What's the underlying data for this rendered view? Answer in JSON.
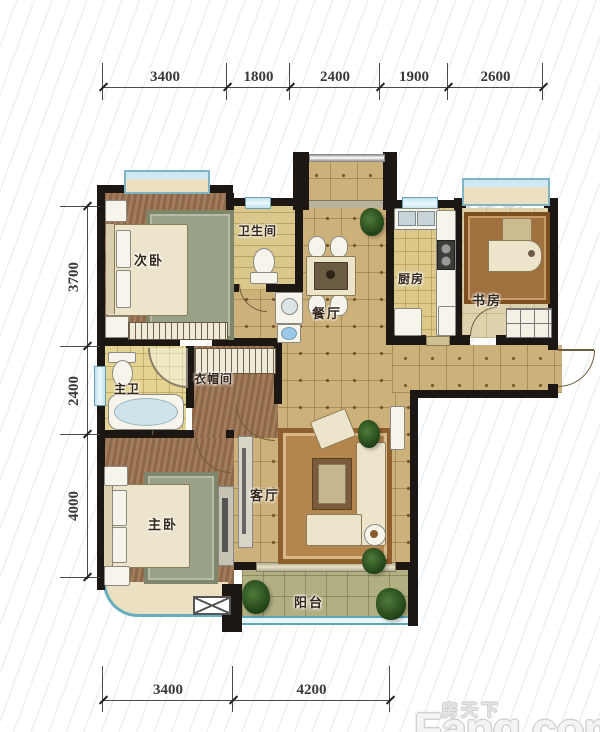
{
  "rooms": {
    "ciwo": "次卧",
    "weishengjian": "卫生间",
    "canting": "餐厅",
    "chufang": "厨房",
    "shufang": "书房",
    "zhuwei": "主卫",
    "yimaojian": "衣帽间",
    "zhuwo": "主卧",
    "keting": "客厅",
    "yangtai": "阳台"
  },
  "dimensions": {
    "top": [
      "3400",
      "1800",
      "2400",
      "1900",
      "2600"
    ],
    "left": [
      "3700",
      "2400",
      "4000"
    ],
    "bottom": [
      "3400",
      "4200"
    ]
  },
  "watermarks": {
    "brand": "诸葛找房",
    "site_cn": "房天下",
    "site_en": "Fang.com"
  },
  "colors": {
    "wall": "#1c1712",
    "tile_floor": "#cdb17a",
    "wood_floor": "#9b7453",
    "window_blue": "#bfe2ef",
    "balcony_rail": "#5aa7b8",
    "dimension_line": "#4a4a4a"
  }
}
